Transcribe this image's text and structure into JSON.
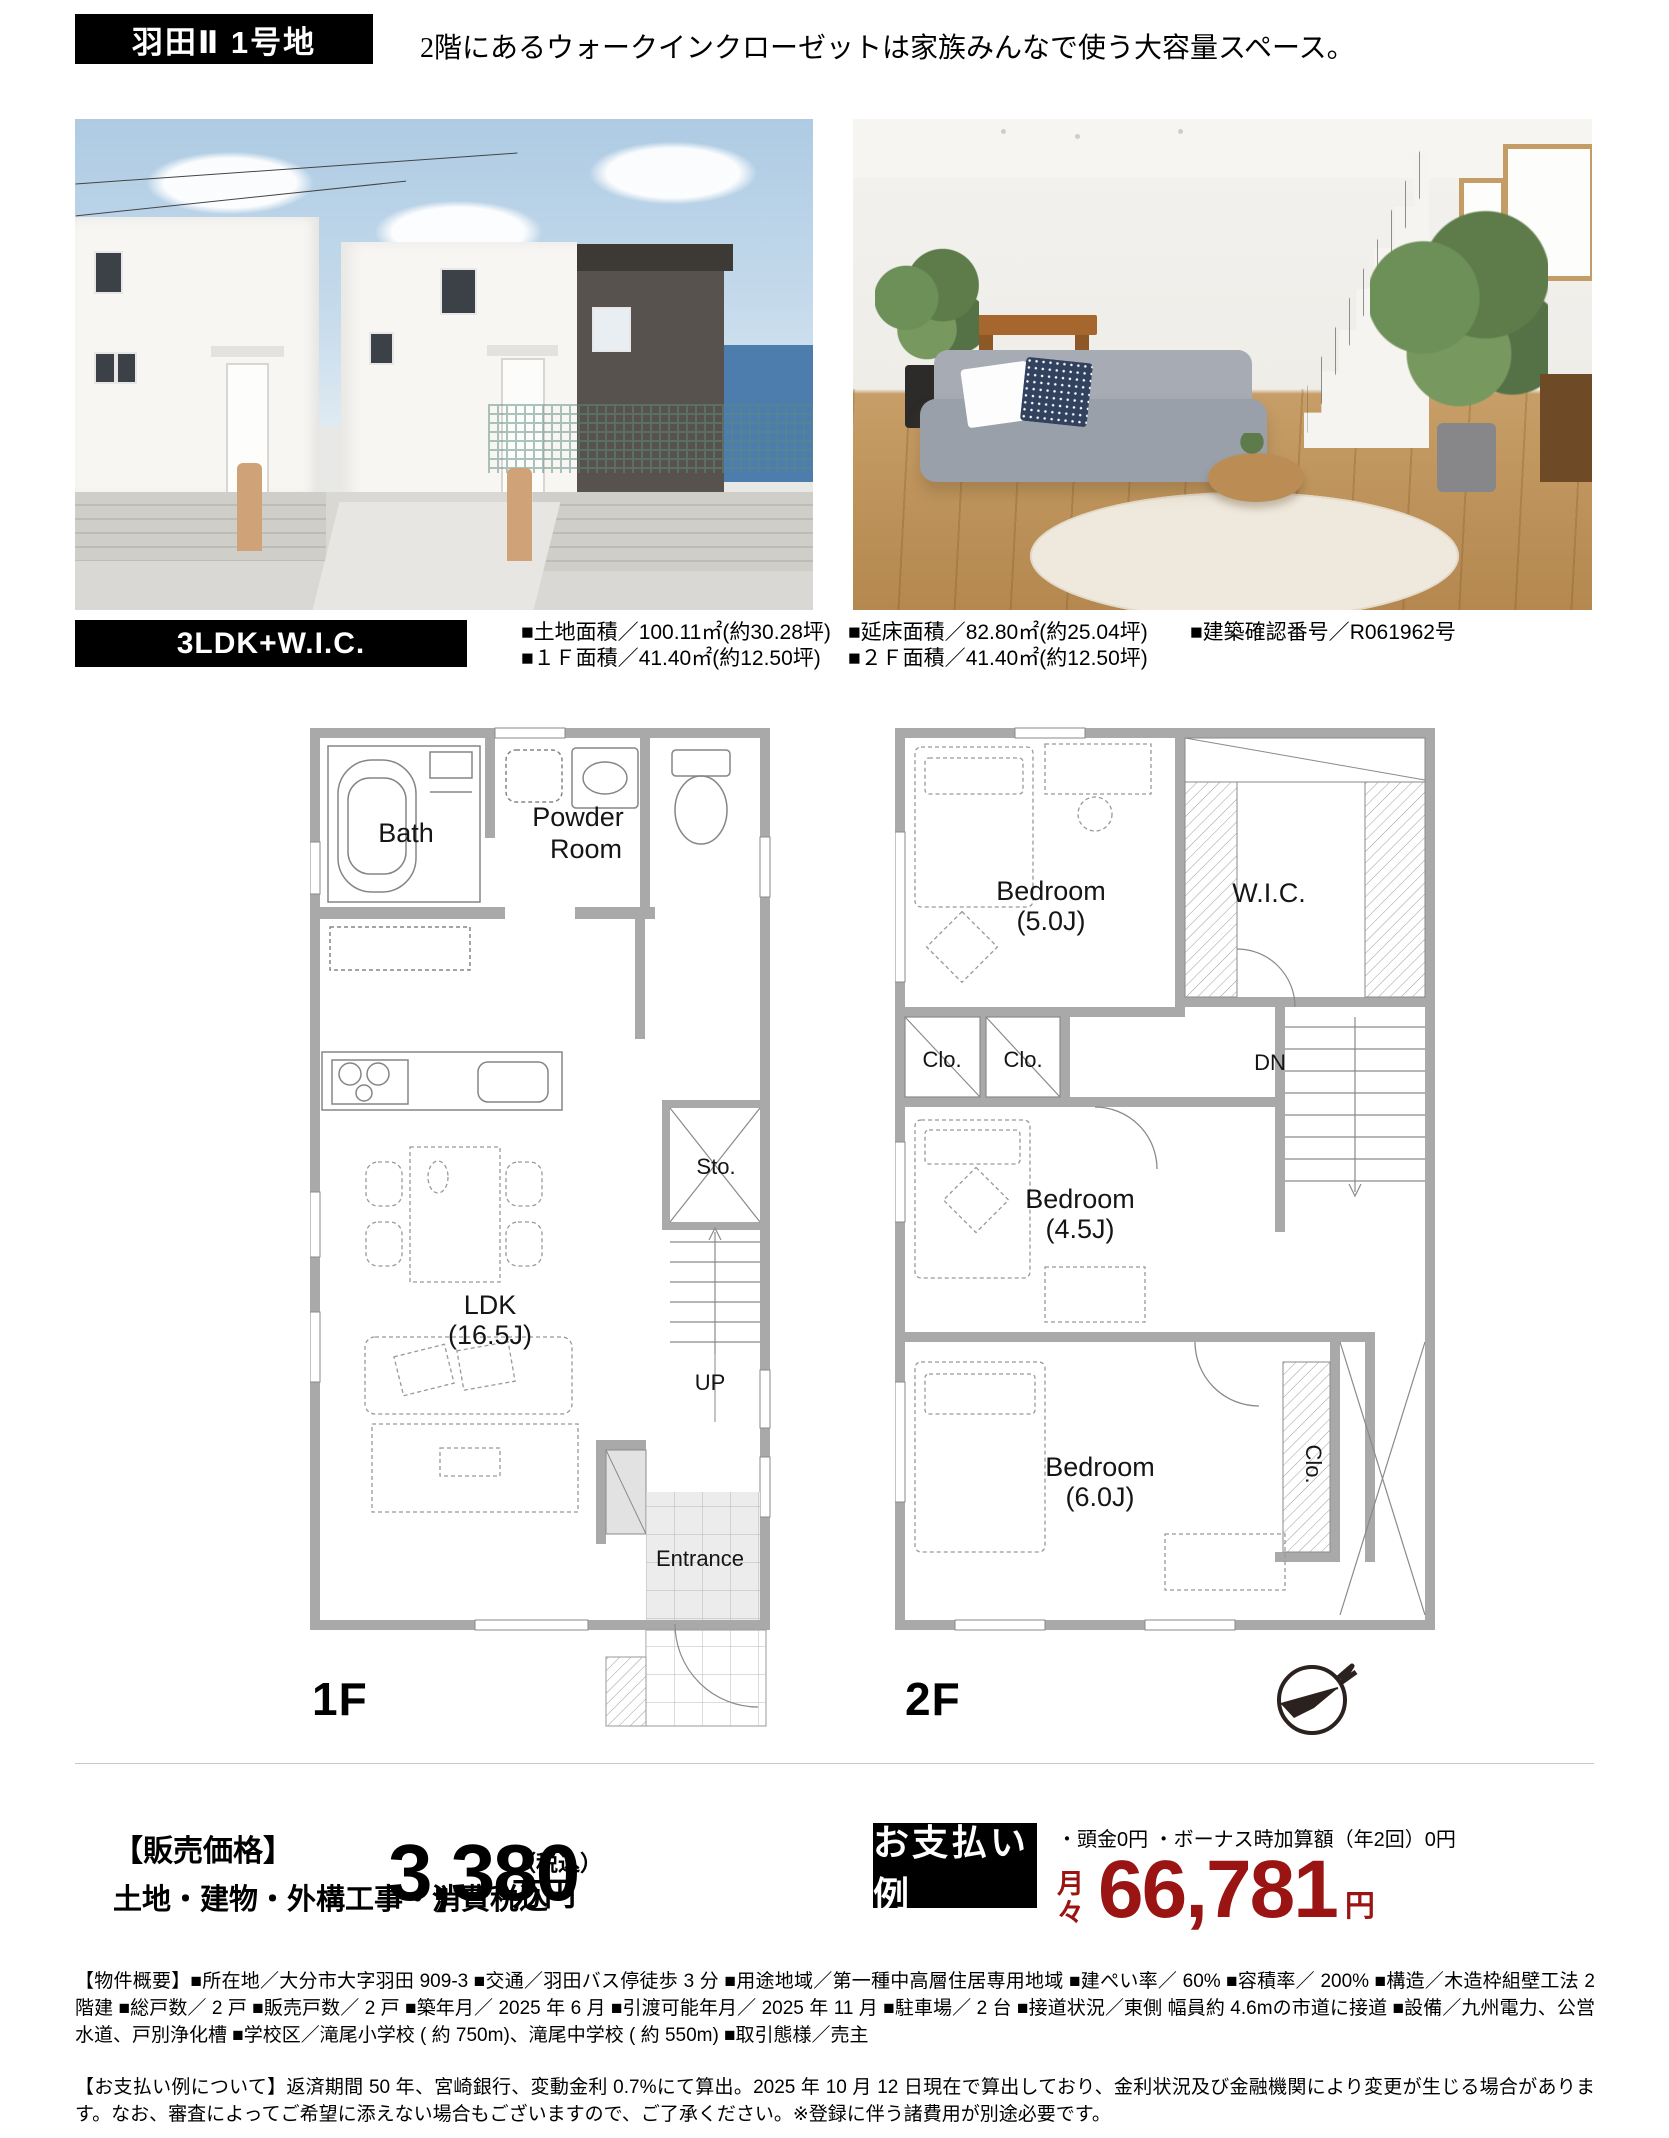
{
  "header": {
    "lot_badge": "羽田Ⅱ 1号地",
    "tagline": "2階にあるウォークインクローゼットは家族みんなで使う大容量スペース。"
  },
  "summary": {
    "plan_badge": "3LDK+W.I.C.",
    "specs": {
      "land_label": "■土地面積／",
      "land_value": "100.11㎡(約30.28坪)",
      "total_label": "■延床面積／",
      "total_value": "82.80㎡(約25.04坪)",
      "permit_label": "■建築確認番号／",
      "permit_value": "R061962号",
      "f1_label": "■１Ｆ面積／",
      "f1_value": "41.40㎡(約12.50坪)",
      "f2_label": "■２Ｆ面積／",
      "f2_value": "41.40㎡(約12.50坪)"
    }
  },
  "floorplans": {
    "f1": {
      "floor_label": "1F",
      "bath": "Bath",
      "powder_line1": "Powder",
      "powder_line2": "Room",
      "sto": "Sto.",
      "ldk_line1": "LDK",
      "ldk_line2": "(16.5J)",
      "up": "UP",
      "entrance": "Entrance"
    },
    "f2": {
      "floor_label": "2F",
      "bedroom1_line1": "Bedroom",
      "bedroom1_line2": "(5.0J)",
      "wic": "W.I.C.",
      "clo1": "Clo.",
      "clo2": "Clo.",
      "dn": "DN",
      "bedroom2_line1": "Bedroom",
      "bedroom2_line2": "(4.5J)",
      "bedroom3_line1": "Bedroom",
      "bedroom3_line2": "(6.0J)",
      "clo3": "Clo."
    }
  },
  "price": {
    "heading": "【販売価格】",
    "tax_line": "土地・建物・外構工事・消費税込",
    "amount": "3,380",
    "amount_unit": "万円",
    "tax_note": "（税込）",
    "payment_badge": "お支払い例",
    "payment_conditions": "・頭金0円 ・ボーナス時加算額（年2回）0円",
    "monthly_label_1": "月",
    "monthly_label_2": "々",
    "monthly_amount": "66,781",
    "monthly_unit": "円"
  },
  "colors": {
    "accent_red": "#9a1414",
    "badge_black": "#000000",
    "wall_gray": "#a9a9a9"
  },
  "footer": {
    "overview": "【物件概要】■所在地／大分市大字羽田 909-3 ■交通／羽田バス停徒歩 3 分 ■用途地域／第一種中高層住居専用地域 ■建ぺい率／ 60% ■容積率／ 200% ■構造／木造枠組壁工法 2 階建 ■総戸数／ 2 戸 ■販売戸数／ 2 戸 ■築年月／ 2025 年 6 月 ■引渡可能年月／ 2025 年 11 月 ■駐車場／ 2 台 ■接道状況／東側 幅員約 4.6mの市道に接道 ■設備／九州電力、公営水道、戸別浄化槽 ■学校区／滝尾小学校 ( 約 750m)、滝尾中学校 ( 約 550m) ■取引態様／売主",
    "payment_note": "【お支払い例について】返済期間 50 年、宮崎銀行、変動金利 0.7%にて算出。2025 年 10 月 12 日現在で算出しており、金利状況及び金融機関により変更が生じる場合があります。なお、審査によってご希望に添えない場合もございますので、ご了承ください。※登録に伴う諸費用が別途必要です。"
  }
}
